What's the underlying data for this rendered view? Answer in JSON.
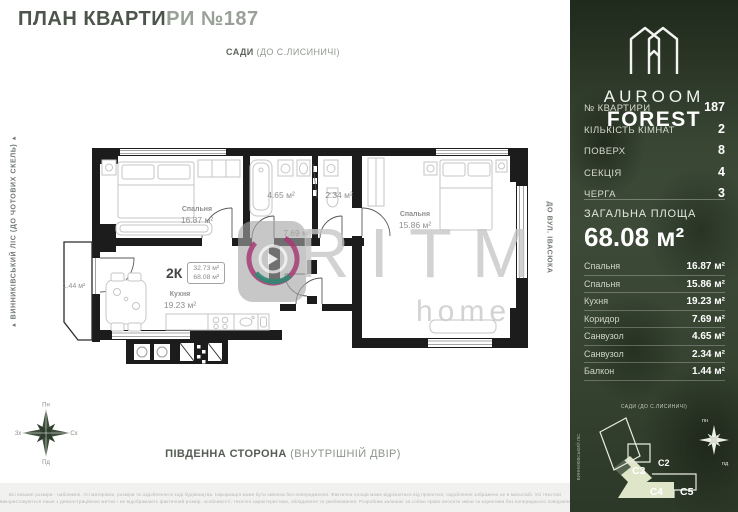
{
  "title": {
    "part1": "ПЛАН КВАРТИ",
    "part2": "РИ №187"
  },
  "orientation": {
    "top": {
      "bold": "САДИ",
      "rest": " (ДО С.ЛИСИНИЧІ)"
    },
    "bottom": {
      "bold": "ПІВДЕННА СТОРОНА",
      "rest": " (ВНУТРІШНІЙ ДВІР)"
    },
    "left": "ВИННИКІВСЬКИЙ ЛІС (ДО ЧОТОВИХ СКЕЛЬ)",
    "right": "ДО ВУЛ. ІВАСЮКА"
  },
  "compass": {
    "n": "Пн",
    "e": "Сх",
    "s": "Пд",
    "w": "Зх"
  },
  "plan": {
    "rooms": {
      "bedroom1": {
        "name": "Спальня",
        "area": "16.87 м²"
      },
      "bedroom2": {
        "name": "Спальня",
        "area": "15.86 м²"
      },
      "kitchen": {
        "name": "Кухня",
        "area": "19.23 м²"
      },
      "bathroom": {
        "area": "4.65 м²"
      },
      "wc": {
        "area": "2.34 м²"
      },
      "corridor": {
        "area": "7.69 м²"
      },
      "balcony": {
        "area": "1.44 м²"
      }
    },
    "summary": {
      "type": "2К",
      "living_area": "32.73 м²",
      "total_area": "68.08 м²"
    }
  },
  "watermark": {
    "brand": "RITM",
    "sub": "home"
  },
  "panel": {
    "brand": {
      "line1": "AUROOM",
      "line2": "FOREST"
    },
    "info": [
      {
        "label": "№ КВАРТИРИ",
        "value": "187"
      },
      {
        "label": "КІЛЬКІСТЬ КІМНАТ",
        "value": "2"
      },
      {
        "label": "ПОВЕРХ",
        "value": "8"
      },
      {
        "label": "СЕКЦІЯ",
        "value": "4"
      },
      {
        "label": "ЧЕРГА",
        "value": "3"
      }
    ],
    "total": {
      "label": "ЗАГАЛЬНА ПЛОЩА",
      "value": "68.08 м²"
    },
    "rooms": [
      {
        "name": "Спальня",
        "area": "16.87 м²"
      },
      {
        "name": "Спальня",
        "area": "15.86 м²"
      },
      {
        "name": "Кухня",
        "area": "19.23 м²"
      },
      {
        "name": "Коридор",
        "area": "7.69 м²"
      },
      {
        "name": "Санвузол",
        "area": "4.65 м²"
      },
      {
        "name": "Санвузол",
        "area": "2.34 м²"
      },
      {
        "name": "Балкон",
        "area": "1.44 м²"
      }
    ],
    "siteplan": {
      "label": "САДИ (ДО С.ЛИСИНИЧІ)",
      "side_label": "ВИННИКІВСЬКИЙ ЛІС",
      "sections": [
        "C2",
        "C3",
        "C4",
        "C5"
      ],
      "compass": {
        "n": "пн",
        "s": "пд"
      }
    }
  },
  "disclaimer": {
    "line1": "Всі вказані розміри - наближені. Усі матеріали, розміри та оздоблення в ході будівництва. Інформація може бути змінена без попередження. Фактична площа може відрізнятися від проектної, оздоблення зображено не в масштабі. Усі текстові",
    "line2": "використовуються лише з демонстраційною метою і не відображають фактичний розмір, особливості, технічні характеристики, обладнання та умеблювання. Розробник залишає за собою право вносити зміни та корективи без попереднього повідомлення."
  },
  "colors": {
    "panel_green": "#36432f",
    "site_highlight": "#dfe5c9",
    "wall": "#1c1c1c",
    "watermark_ring": "#a63a74",
    "watermark_arc": "#2e8a74"
  }
}
